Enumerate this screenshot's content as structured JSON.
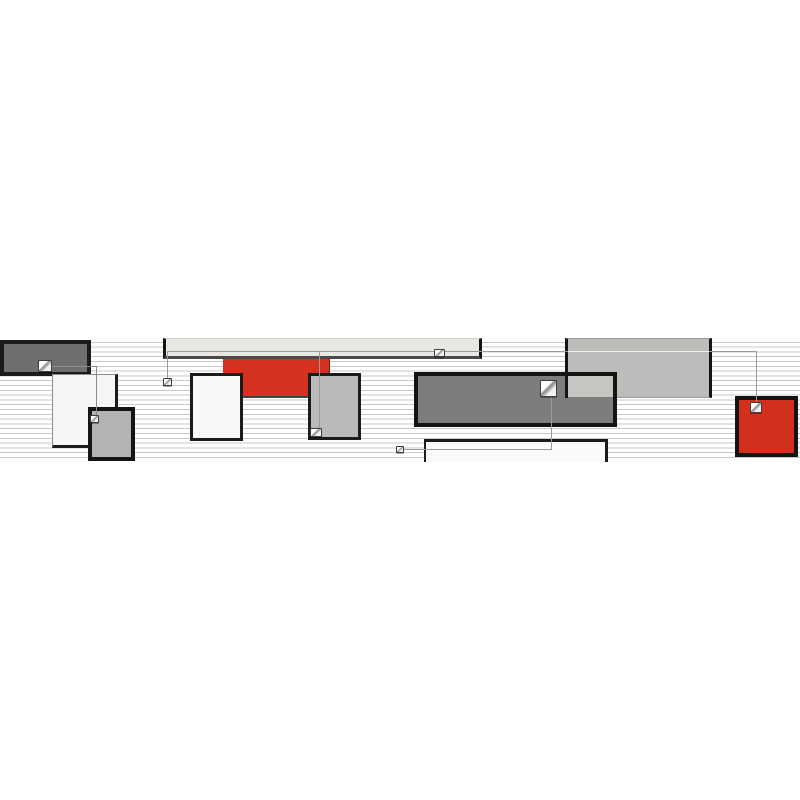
{
  "artwork": {
    "title": "abstract-geometric-border-composition",
    "canvas": {
      "width": 800,
      "height": 800,
      "background": "#ffffff"
    },
    "band": {
      "top": 338,
      "height": 124
    },
    "palette": {
      "accent_red": "#d2301c",
      "dark_gray": "#7d7d7d",
      "mid_gray": "#bcbab8",
      "light_gray": "#e8e7e4",
      "near_black": "#141414",
      "stripe_gray": "#c8c8c8",
      "connector_gray": "#9b9b9b",
      "white": "#fafafa"
    },
    "layers": [
      {
        "type": "stripes",
        "name": "pinstripe-band",
        "x": 0,
        "y": 338,
        "w": 800,
        "h": 124,
        "pitch": 4.8,
        "thickness": 1,
        "color": "#c8c8c8"
      },
      {
        "type": "rect",
        "name": "rect-dark-topleft",
        "x": 0,
        "y": 340,
        "w": 91,
        "h": 36,
        "bg": "#6f6f6f",
        "border": "4px solid #1b1b1b"
      },
      {
        "type": "rect",
        "name": "rect-white-left",
        "x": 52,
        "y": 374,
        "w": 66,
        "h": 74,
        "bg": "#f5f5f3",
        "bt": "1px solid #8d8d8d",
        "bl": "1px solid #8d8d8d",
        "br": "3px solid #1b1b1b",
        "bb": "3px solid #1b1b1b"
      },
      {
        "type": "rect",
        "name": "rect-gray-small-left",
        "x": 88,
        "y": 407,
        "w": 47,
        "h": 54,
        "bg": "#b3b3b3",
        "border": "4px solid #141414"
      },
      {
        "type": "rect",
        "name": "bar-light-top",
        "x": 163,
        "y": 338,
        "w": 319,
        "h": 21,
        "bg": "#e8e7e4",
        "bt": "1px solid #cfcfcf",
        "bl": "3px solid #141414",
        "br": "3px solid #141414",
        "bb": "3px solid #4a4a4a"
      },
      {
        "type": "rect",
        "name": "rect-red-top",
        "x": 223,
        "y": 359,
        "w": 107,
        "h": 39,
        "bg": "#d43120",
        "br": "1px solid #7a1a0c",
        "bb": "2px solid #454545"
      },
      {
        "type": "rect",
        "name": "rect-white-mid",
        "x": 190,
        "y": 373,
        "w": 53,
        "h": 68,
        "bg": "#f8f8f6",
        "border": "3px solid #1b1b1b"
      },
      {
        "type": "rect",
        "name": "rect-gray-mid",
        "x": 308,
        "y": 373,
        "w": 53,
        "h": 67,
        "bg": "#bcbab8",
        "border": "3px solid #1b1b1b"
      },
      {
        "type": "rect",
        "name": "rect-gray-topright",
        "x": 565,
        "y": 338,
        "w": 147,
        "h": 60,
        "bg": "#bdbcba",
        "bt": "1px solid #979797",
        "bl": "3px solid #141414",
        "br": "3px solid #141414",
        "bb": "1px solid #9a9a9a"
      },
      {
        "type": "rect",
        "name": "rect-dark-center",
        "x": 414,
        "y": 372,
        "w": 203,
        "h": 55,
        "bg": "#7d7d7d",
        "border": "4px solid #141414"
      },
      {
        "type": "rect",
        "name": "patch-overlap-light",
        "x": 567,
        "y": 376,
        "w": 46,
        "h": 21,
        "bg": "#c6c5c2"
      },
      {
        "type": "rect",
        "name": "edge-overlay-dark",
        "x": 565,
        "y": 372,
        "w": 3,
        "h": 26,
        "bg": "#141414"
      },
      {
        "type": "rect",
        "name": "rect-white-bottom",
        "x": 424,
        "y": 439,
        "w": 184,
        "h": 23,
        "bg": "#fafafa",
        "bt": "3px solid #1b1b1b",
        "bl": "2px solid #1b1b1b",
        "br": "3px solid #1b1b1b"
      },
      {
        "type": "rect",
        "name": "rect-red-right",
        "x": 735,
        "y": 396,
        "w": 63,
        "h": 61,
        "bg": "#d2301c",
        "border": "4px solid #141414"
      },
      {
        "type": "line",
        "name": "connector-h-left",
        "x": 52,
        "y": 366,
        "w": 44,
        "h": 1,
        "bg": "#8c8c8c"
      },
      {
        "type": "line",
        "name": "connector-v-left",
        "x": 96,
        "y": 366,
        "w": 1,
        "h": 50,
        "bg": "#8c8c8c"
      },
      {
        "type": "line",
        "name": "connector-h-main",
        "x": 167,
        "y": 351,
        "w": 590,
        "h": 1,
        "bg": "#9b9b9b"
      },
      {
        "type": "line",
        "name": "connector-h-main-light-segment",
        "x": 568,
        "y": 351,
        "w": 141,
        "h": 1,
        "bg": "#eeedea"
      },
      {
        "type": "line",
        "name": "connector-v-band-left",
        "x": 167,
        "y": 351,
        "w": 1,
        "h": 28,
        "bg": "#9b9b9b"
      },
      {
        "type": "line",
        "name": "connector-v-through-red",
        "x": 319,
        "y": 351,
        "w": 1,
        "h": 79,
        "bg": "#9b9b9b"
      },
      {
        "type": "line",
        "name": "connector-v-to-red-square",
        "x": 756,
        "y": 351,
        "w": 1,
        "h": 53,
        "bg": "#9b9b9b"
      },
      {
        "type": "line",
        "name": "connector-v-center-down",
        "x": 551,
        "y": 396,
        "w": 1,
        "h": 54,
        "bg": "#9b9b9b"
      },
      {
        "type": "line",
        "name": "connector-h-bottom",
        "x": 403,
        "y": 449,
        "w": 149,
        "h": 1,
        "bg": "#9b9b9b"
      },
      {
        "type": "page-icon",
        "name": "page-icon-dark-topleft",
        "x": 38,
        "y": 360,
        "w": 14,
        "h": 12
      },
      {
        "type": "page-icon",
        "name": "page-icon-gray-small-left",
        "x": 90,
        "y": 415,
        "w": 9,
        "h": 8
      },
      {
        "type": "page-icon",
        "name": "page-icon-below-bar",
        "x": 163,
        "y": 378,
        "w": 9,
        "h": 8
      },
      {
        "type": "page-icon",
        "name": "page-icon-gray-mid",
        "x": 310,
        "y": 428,
        "w": 12,
        "h": 9
      },
      {
        "type": "page-icon",
        "name": "page-icon-in-bar",
        "x": 434,
        "y": 349,
        "w": 11,
        "h": 8
      },
      {
        "type": "page-icon",
        "name": "page-icon-dark-center",
        "x": 540,
        "y": 380,
        "w": 17,
        "h": 17
      },
      {
        "type": "page-icon",
        "name": "page-icon-red-right",
        "x": 750,
        "y": 402,
        "w": 12,
        "h": 11
      },
      {
        "type": "page-icon",
        "name": "page-icon-bottom-left",
        "x": 396,
        "y": 446,
        "w": 8,
        "h": 7
      }
    ]
  }
}
